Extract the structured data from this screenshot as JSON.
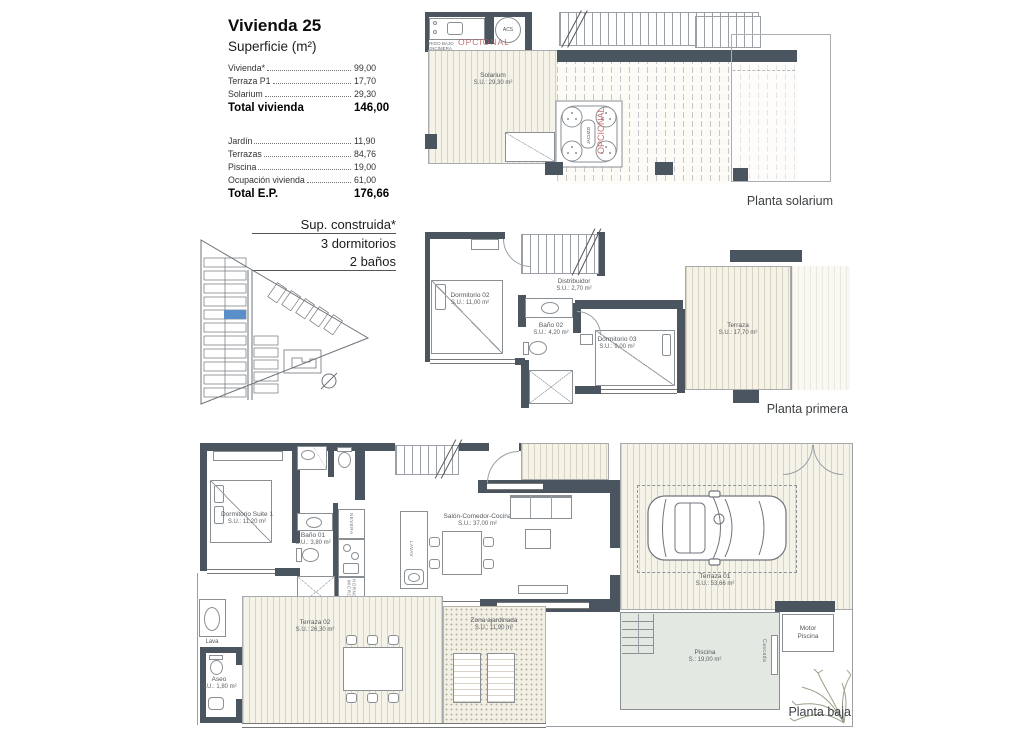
{
  "title_block": {
    "title": "Vivienda 25",
    "subtitle": "Superficie (m²)",
    "rows_top": [
      {
        "label": "Vivienda*",
        "value": "99,00"
      },
      {
        "label": "Terraza P1",
        "value": "17,70"
      },
      {
        "label": "Solarium",
        "value": "29,30"
      }
    ],
    "total_top": {
      "label": "Total vivienda",
      "value": "146,00"
    },
    "rows_bottom": [
      {
        "label": "Jardín",
        "value": "11,90"
      },
      {
        "label": "Terrazas",
        "value": "84,76"
      },
      {
        "label": "Piscina",
        "value": "19,00"
      },
      {
        "label": "Ocupación vivienda",
        "value": "61,00"
      }
    ],
    "total_bottom": {
      "label": "Total E.P.",
      "value": "176,66"
    }
  },
  "spec_block": {
    "line1": "Sup. construida*",
    "line2": "3 dormitorios",
    "line3": "2 baños"
  },
  "plan_solarium": {
    "caption": "Planta solarium",
    "room_solarium": {
      "name": "Solarium",
      "area": "S.U.: 29,30 m²"
    },
    "optional_label": "OPCIONAL",
    "jacuzzi_label": "JACUZZI",
    "jacuzzi_optional_label": "OPCIONAL",
    "acs_label": "ACS",
    "frigo_label": "FRIGO BAJO ENCIMERA"
  },
  "plan_primera": {
    "caption": "Planta primera",
    "room_dorm02": {
      "name": "Dormitorio 02",
      "area": "S.U.: 11,00 m²"
    },
    "room_distribuidor": {
      "name": "Distribuidor",
      "area": "S.U.: 2,70 m²"
    },
    "room_bano02": {
      "name": "Baño 02",
      "area": "S.U.: 4,20 m²"
    },
    "room_dorm03": {
      "name": "Dormitorio 03",
      "area": "S.U.: 9,00 m²"
    },
    "room_terraza": {
      "name": "Terraza",
      "area": "S.U.: 17,70 m²"
    }
  },
  "plan_baja": {
    "caption": "Planta baja",
    "room_suite": {
      "name": "Dormitorio Suite 1",
      "area": "S.U.: 11,20 m²"
    },
    "room_bano01": {
      "name": "Baño 01",
      "area": "S.U.: 3,80 m²"
    },
    "room_salon": {
      "name": "Salón-Comedor-Cocina",
      "area": "S.U.: 37,00 m²"
    },
    "room_terraza02": {
      "name": "Terraza 02",
      "area": "S.U.: 26,30 m²"
    },
    "room_zona": {
      "name": "Zona ajardinada",
      "area": "S.U.: 11,90 m²"
    },
    "room_terraza01": {
      "name": "Terraza 01",
      "area": "S.U.: 53,66 m²"
    },
    "room_piscina": {
      "name": "Piscina",
      "area": "S.: 19,00 m²"
    },
    "room_aseo": {
      "name": "Aseo",
      "area": "S.U.: 1,80 m²"
    },
    "room_motor": {
      "name": "Motor Piscina"
    },
    "label_lava": "Lava",
    "label_cascada": "Cascada",
    "label_nevera": "NEVERA",
    "label_horno": "HORNO MICRO",
    "label_lavav": "LAVAV"
  },
  "colors": {
    "wall": "#4a5560",
    "accent_red": "#b5585b",
    "highlight_blue": "#5b8fc9"
  }
}
